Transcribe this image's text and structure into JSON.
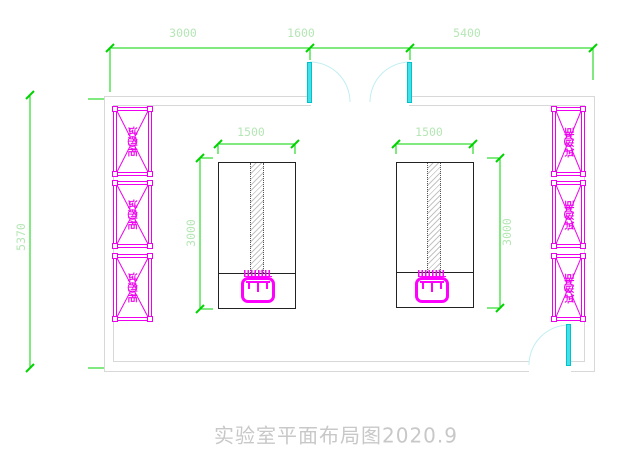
{
  "page": {
    "title_caption": "实验室平面布局图2020.9"
  },
  "dimensions": {
    "top_segment_1": "3000",
    "top_segment_2": "1600",
    "top_segment_3": "5400",
    "room_depth": "5370",
    "left_bench_width": "1500",
    "left_bench_length": "3000",
    "right_bench_width": "1500",
    "right_bench_length": "3000"
  },
  "cabinets": {
    "left": [
      {
        "label": "试剂柜"
      },
      {
        "label": "试剂柜"
      },
      {
        "label": "试剂柜"
      }
    ],
    "right": [
      {
        "label": "试剂柜"
      },
      {
        "label": "试剂柜"
      },
      {
        "label": "试剂柜"
      }
    ]
  },
  "colors": {
    "dimension_line": "#00d400",
    "dimension_text": "#b5e6b5",
    "cabinet": "#ee00ee",
    "sink": "#ff00ff",
    "door_leaf": "#45dfe8",
    "door_arc": "#c0eef2",
    "wall": "#d8d8d8",
    "bench_outline": "#222222",
    "title_text": "#c8c8c8"
  }
}
